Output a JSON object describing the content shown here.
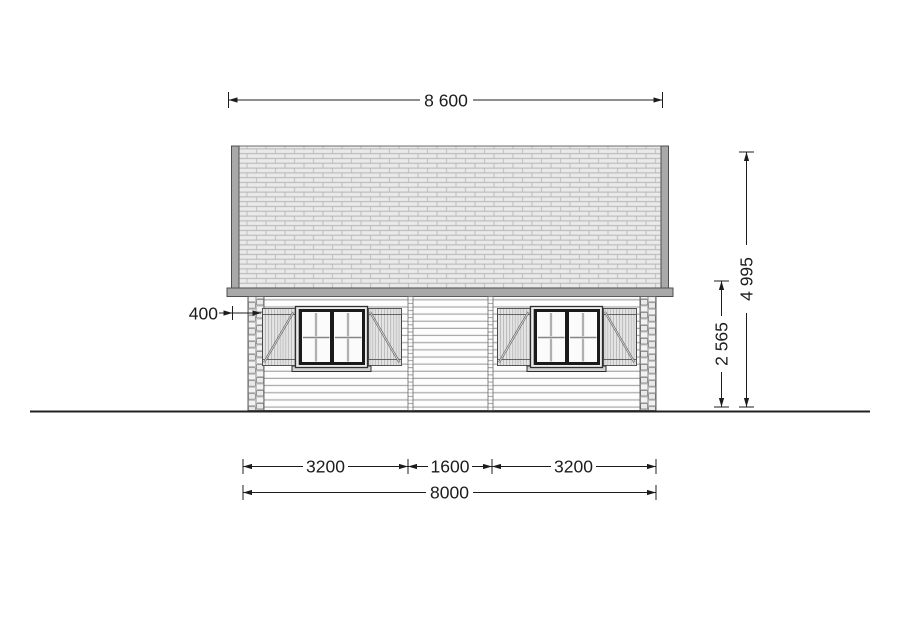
{
  "drawing": {
    "title": "log-cabin-front-elevation",
    "dimensions": {
      "roof_width": "8 600",
      "total_height": "4 995",
      "wall_height": "2 565",
      "corner_offset": "400",
      "bottom_left_segment": "3200",
      "bottom_middle_segment": "1600",
      "bottom_right_segment": "3200",
      "wall_width": "8000"
    },
    "colors": {
      "background": "#ffffff",
      "dimension_line": "#1c1c1c",
      "roof_brick_fill": "#eaeaea",
      "roof_mortar": "#a2a2a2",
      "trim_gray": "#a9a9a9",
      "wall_fill": "#fdfdfd",
      "siding_line": "#8c8c8c",
      "sash_frame": "#1a1a1a"
    }
  }
}
